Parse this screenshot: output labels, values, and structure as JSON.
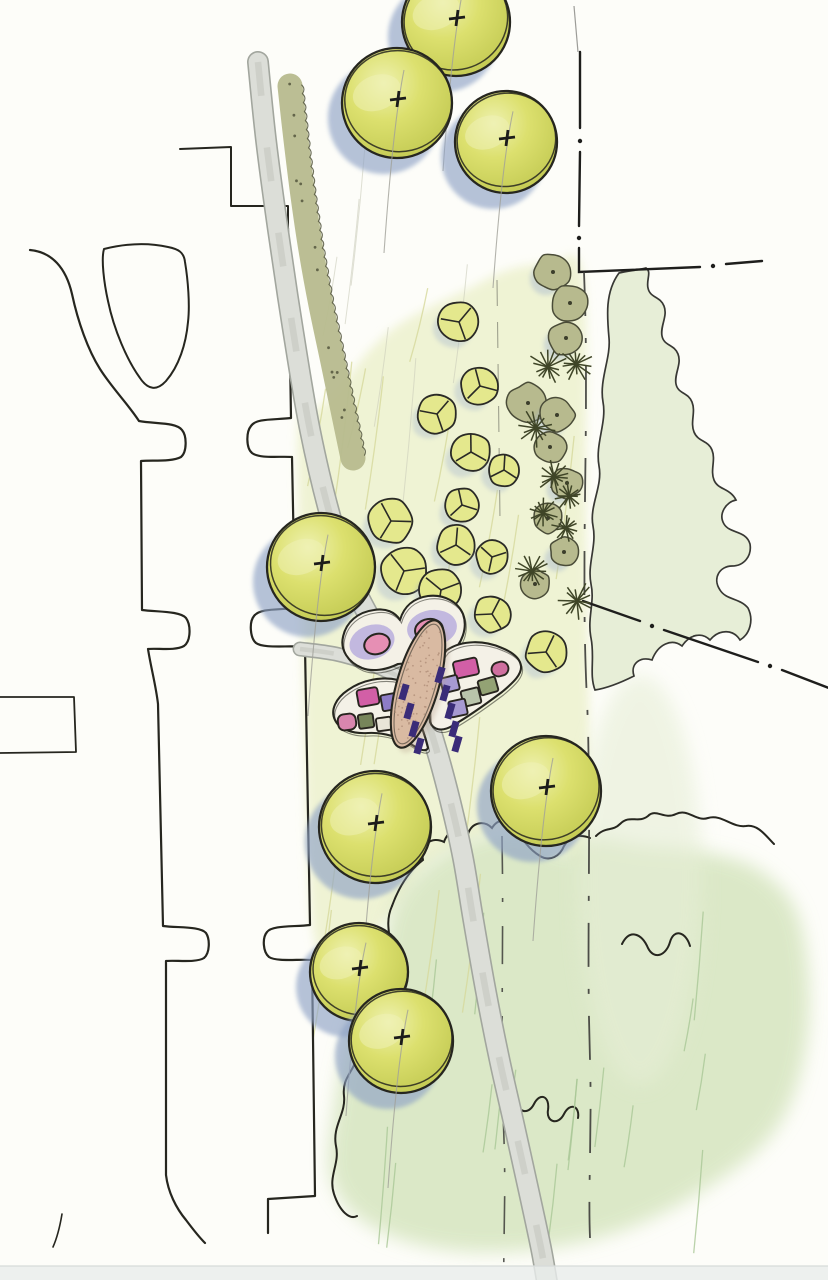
{
  "meta": {
    "width": 828,
    "height": 1280,
    "description": "Hand-drawn landscape architecture site plan sketch: street with curb cuts on the left, curving pedestrian path, watercolor shade trees, shrub and ornamental-grass border, lawn and meadow washes, property dash-dot lines, and a butterfly-shaped planting garden with benches at the center"
  },
  "palette": {
    "paper": "#fdfdf9",
    "ink": "#26261f",
    "pencil_gray": "#a6a69e",
    "tree_fill": "#dce06e",
    "tree_light": "#eef1b0",
    "tree_dark": "#c2c952",
    "tree_shadow": "#8fa3c6",
    "small_tree_fill": "#e4e88d",
    "shrub_olive": "#b7ba8e",
    "shrub_ink": "#4a4c38",
    "star_ink": "#3f4527",
    "lawn": "#eef2d0",
    "meadow": "#d6e5bf",
    "grove": "#e6eed6",
    "hatch_lawn": "#d6d89b",
    "hatch_meadow": "#a9c796",
    "path_fill": "#dcded8",
    "path_edge": "#a2a69e",
    "body_tan": "#d9baa2",
    "body_stipple": "#b08f79",
    "bench_purple": "#3a2c78",
    "wing_cream": "#f4f1e7",
    "wing_lavender": "#b9aedd",
    "wing_pink": "#e68fb4",
    "bottom_band": "#e9eceb"
  },
  "scene": {
    "inks": [
      {
        "name": "building-step-north",
        "d": "M 180,149 L 231,147 L 231,206 L 288,206 L 288,228",
        "w": 2
      },
      {
        "name": "curb-right",
        "d": "M 288,228 L 291,418 C 275,420 256,418 251,426 C 246,432 246,448 252,453 C 260,459 280,456 292,457 L 295,608 C 279,610 260,608 254,616 C 249,622 250,638 256,643 C 264,649 290,645 305,647 L 310,925 C 294,927 272,925 267,932 C 262,938 263,952 269,957 C 277,962 298,959 312,960 L 315,1196 L 268,1199 L 268,1233",
        "w": 2.2
      },
      {
        "name": "curb-left",
        "d": "M 30,250 C 52,252 66,268 72,294 C 78,322 88,350 100,369 C 112,388 128,404 139,421 C 155,424 176,422 182,430 C 187,436 187,452 181,457 C 172,462 152,460 141,461 L 142,610 C 158,612 180,611 186,618 C 191,625 191,641 184,646 C 175,651 158,648 148,649 C 151,668 156,686 158,704 L 163,926 C 178,928 200,926 206,933 C 210,939 210,953 204,958 C 196,963 176,960 166,961 L 166,1175 C 168,1192 176,1208 186,1220 C 192,1228 198,1236 205,1243",
        "w": 2.2
      },
      {
        "name": "existing-canopy-loop",
        "d": "M 104,249 C 128,243 150,243 168,247 C 178,249 184,252 185,262 C 188,280 190,305 188,322 C 186,344 179,366 166,381 C 157,391 148,390 140,378 C 127,360 114,330 108,301 C 104,283 101,259 104,249 Z",
        "w": 2
      },
      {
        "name": "stub-west",
        "d": "M 0,697 L 74,697 L 76,752 L 0,753",
        "w": 1.8
      },
      {
        "name": "stub-southwest",
        "d": "M 62,1214 C 60,1226 57,1238 53,1247",
        "w": 1.6
      }
    ],
    "boundary": {
      "segs": [
        "M 580,52 L 580,128",
        "M 580,152 L 579,226",
        "M 579,248 L 579,272 L 700,267",
        "M 726,264 L 762,261",
        "M 583,601 L 640,621",
        "M 664,630 L 758,662",
        "M 782,670 L 834,690"
      ],
      "dots": [
        [
          580,
          141
        ],
        [
          579,
          238
        ],
        [
          713,
          266
        ],
        [
          652,
          626
        ],
        [
          770,
          666
        ]
      ]
    },
    "dashed_lines": [
      {
        "name": "swale-line-east",
        "d": "M 584,272 C 590,420 580,560 587,700 C 592,820 586,940 590,1060 C 592,1130 588,1190 590,1238",
        "w": 1.8,
        "da": "44 22 5 22",
        "op": 0.9
      },
      {
        "name": "swale-line-west",
        "d": "M 502,836 C 504,940 500,1040 504,1140 C 506,1200 503,1248 504,1280",
        "w": 1.6,
        "da": "38 24 4 24",
        "op": 0.85
      },
      {
        "name": "pencil-guide-1",
        "d": "M 497,280 L 500,520",
        "w": 1.1,
        "da": "26 16",
        "op": 0.45
      },
      {
        "name": "pencil-guide-2",
        "d": "M 574,6 L 578,52",
        "w": 1.2,
        "da": "60 1",
        "op": 0.5
      }
    ],
    "lawn_poly": [
      [
        298,
        432
      ],
      [
        302,
        620
      ],
      [
        314,
        936
      ],
      [
        356,
        948
      ],
      [
        398,
        904
      ],
      [
        432,
        862
      ],
      [
        482,
        836
      ],
      [
        530,
        828
      ],
      [
        562,
        850
      ],
      [
        588,
        838
      ],
      [
        586,
        500
      ],
      [
        583,
        276
      ],
      [
        550,
        264
      ],
      [
        508,
        270
      ],
      [
        466,
        290
      ],
      [
        428,
        308
      ],
      [
        394,
        328
      ],
      [
        366,
        354
      ],
      [
        338,
        390
      ],
      [
        312,
        414
      ]
    ],
    "meadow_poly": [
      [
        392,
        908
      ],
      [
        422,
        868
      ],
      [
        472,
        838
      ],
      [
        526,
        830
      ],
      [
        566,
        852
      ],
      [
        592,
        838
      ],
      [
        644,
        846
      ],
      [
        704,
        852
      ],
      [
        762,
        872
      ],
      [
        800,
        922
      ],
      [
        808,
        1030
      ],
      [
        778,
        1126
      ],
      [
        700,
        1192
      ],
      [
        598,
        1238
      ],
      [
        478,
        1252
      ],
      [
        382,
        1232
      ],
      [
        332,
        1182
      ],
      [
        336,
        1098
      ],
      [
        352,
        1028
      ],
      [
        376,
        984
      ]
    ],
    "grove_path": "M 619,273 C 605,292 607,316 609,338 C 611,358 599,380 603,402 C 607,422 595,444 599,466 C 603,486 589,506 593,526 C 597,546 587,564 591,584 C 595,602 587,618 591,638 C 595,658 589,674 595,690 C 608,688 622,682 634,676 C 630,664 640,656 652,660 C 658,644 672,638 682,646 C 690,634 702,632 710,640 C 720,628 734,630 740,640 C 750,634 754,620 748,608 C 740,598 726,600 720,590 C 712,578 720,566 732,566 C 744,566 752,556 750,544 C 746,530 730,534 724,524 C 718,514 726,502 736,500 C 730,488 718,490 714,480 C 710,470 716,460 712,450 C 708,440 698,442 694,432 C 690,422 696,412 692,402 C 688,392 678,394 676,384 C 674,374 682,364 678,354 C 674,344 664,346 662,336 C 660,326 668,316 664,306 C 660,296 650,298 648,288 C 646,280 652,272 646,268 C 638,270 628,271 619,273 Z",
    "meadow_inks": [
      "M 392,906 C 400,884 410,870 423,860 C 420,844 432,836 444,842 C 448,830 460,826 468,834 C 472,822 484,820 492,828 C 498,818 510,818 516,826 C 520,838 530,850 540,856 C 550,862 560,856 564,846 C 570,836 580,834 590,838",
      "M 596,836 C 606,826 612,832 620,824 C 630,814 638,824 648,816 C 656,808 664,820 676,814 C 688,808 696,822 708,818 C 722,814 732,828 746,826 C 758,824 766,836 774,844",
      "M 392,906 C 382,928 396,946 390,966 C 384,986 372,998 378,1014 C 384,1028 364,1038 358,1056 C 352,1074 342,1078 344,1096 C 346,1114 332,1126 336,1146 C 340,1164 328,1176 334,1194 C 340,1212 350,1220 357,1216",
      "M 500,1096 C 508,1078 518,1084 517,1098 C 516,1112 528,1116 534,1104 C 540,1092 550,1096 548,1110 C 546,1122 558,1126 564,1114 C 570,1102 580,1106 578,1118",
      "M 622,944 C 630,928 642,934 648,948 C 654,960 666,956 670,942 C 674,928 686,932 690,946"
    ],
    "main_path": {
      "pts": [
        [
          258,
          62
        ],
        [
          266,
          140
        ],
        [
          278,
          230
        ],
        [
          293,
          330
        ],
        [
          310,
          430
        ],
        [
          330,
          515
        ],
        [
          352,
          582
        ],
        [
          378,
          632
        ],
        [
          402,
          670
        ],
        [
          422,
          706
        ],
        [
          436,
          748
        ],
        [
          450,
          800
        ],
        [
          463,
          858
        ],
        [
          473,
          918
        ],
        [
          486,
          992
        ],
        [
          500,
          1062
        ],
        [
          514,
          1124
        ],
        [
          529,
          1192
        ],
        [
          541,
          1248
        ],
        [
          547,
          1282
        ]
      ],
      "w": 22
    },
    "connector_path": {
      "pts": [
        [
          300,
          649
        ],
        [
          336,
          654
        ],
        [
          370,
          664
        ],
        [
          398,
          676
        ]
      ],
      "w": 15
    },
    "hedge": {
      "pts": [
        [
          290,
          86
        ],
        [
          296,
          140
        ],
        [
          303,
          196
        ],
        [
          311,
          250
        ],
        [
          321,
          305
        ],
        [
          333,
          362
        ],
        [
          344,
          415
        ],
        [
          353,
          458
        ]
      ],
      "w": 25
    },
    "hatch": [
      {
        "name": "lawn-hatch",
        "box": [
          315,
          275,
          265,
          650
        ],
        "count": 18,
        "len": 110,
        "dx": -18,
        "color": "#d6d89b",
        "w": 1.3,
        "op": 0.8,
        "seed": 7
      },
      {
        "name": "meadow-hatch",
        "box": [
          365,
          860,
          400,
          360
        ],
        "count": 16,
        "len": 85,
        "dx": -9,
        "color": "#a9c796",
        "w": 1.3,
        "op": 0.8,
        "seed": 11
      },
      {
        "name": "white-hatch",
        "box": [
          330,
          120,
          180,
          300
        ],
        "count": 6,
        "len": 120,
        "dx": -14,
        "color": "#c9cbb9",
        "w": 1,
        "op": 0.6,
        "seed": 3
      }
    ],
    "large_trees": [
      {
        "x": 456,
        "y": 22,
        "r": 54
      },
      {
        "x": 397,
        "y": 103,
        "r": 55
      },
      {
        "x": 506,
        "y": 142,
        "r": 51
      },
      {
        "x": 321,
        "y": 567,
        "r": 54
      },
      {
        "x": 375,
        "y": 827,
        "r": 56
      },
      {
        "x": 546,
        "y": 791,
        "r": 55
      },
      {
        "x": 359,
        "y": 972,
        "r": 49
      },
      {
        "x": 401,
        "y": 1041,
        "r": 52
      }
    ],
    "small_trees": [
      [
        459,
        322,
        20
      ],
      [
        480,
        386,
        19
      ],
      [
        437,
        414,
        19
      ],
      [
        471,
        452,
        19
      ],
      [
        504,
        470,
        16
      ],
      [
        462,
        505,
        17
      ],
      [
        391,
        521,
        22
      ],
      [
        456,
        545,
        19
      ],
      [
        492,
        557,
        16
      ],
      [
        404,
        571,
        23
      ],
      [
        441,
        590,
        21
      ],
      [
        492,
        614,
        18
      ],
      [
        546,
        652,
        20
      ]
    ],
    "shrubs": [
      [
        553,
        272,
        18
      ],
      [
        570,
        303,
        18
      ],
      [
        566,
        338,
        17
      ],
      [
        528,
        403,
        20
      ],
      [
        557,
        415,
        17
      ],
      [
        550,
        447,
        16
      ],
      [
        567,
        483,
        15
      ],
      [
        548,
        518,
        15
      ],
      [
        564,
        552,
        14
      ],
      [
        535,
        584,
        15
      ]
    ],
    "starbursts": [
      [
        548,
        367,
        20
      ],
      [
        576,
        364,
        18
      ],
      [
        536,
        428,
        20
      ],
      [
        554,
        477,
        17
      ],
      [
        569,
        496,
        15
      ],
      [
        543,
        513,
        16
      ],
      [
        566,
        528,
        15
      ],
      [
        532,
        571,
        18
      ],
      [
        577,
        601,
        20
      ]
    ],
    "butterfly": {
      "upper_wing": "M 398,664 C 386,670 372,672 362,668 C 348,662 340,650 343,637 C 346,622 358,612 374,610 C 386,608 395,612 400,620 C 404,606 414,598 428,596 C 444,594 458,602 463,614 C 468,628 462,644 450,654 C 440,662 428,666 420,662 Z",
      "right_wing": "M 447,650 C 462,640 484,640 502,648 C 512,652 520,658 521,666 C 522,674 514,682 502,692 C 486,704 466,718 452,726 C 442,732 433,730 430,722 C 428,700 432,668 447,650 Z",
      "left_wing": "M 398,680 C 382,676 362,680 348,690 C 336,698 330,710 335,720 C 339,729 352,734 368,733 C 384,732 402,738 414,746 C 420,750 426,752 428,748 C 422,722 408,694 398,680 Z",
      "lavender_lobes": [
        [
          372,
          642,
          23,
          17,
          -18
        ],
        [
          432,
          628,
          25,
          18,
          -8
        ]
      ],
      "pink_rounds": [
        [
          377,
          644,
          13,
          10,
          -18
        ],
        [
          429,
          630,
          14,
          11,
          -8
        ]
      ],
      "beds": [
        [
          466,
          668,
          24,
          17,
          -12,
          "#d25fa6",
          3
        ],
        [
          500,
          669,
          17,
          14,
          -16,
          "#cf6f9f",
          7
        ],
        [
          450,
          684,
          17,
          15,
          -14,
          "#a79ad2",
          2
        ],
        [
          488,
          686,
          18,
          15,
          -16,
          "#93a274",
          2
        ],
        [
          471,
          697,
          18,
          16,
          -14,
          "#b9c4ab",
          2
        ],
        [
          458,
          708,
          17,
          16,
          -12,
          "#a79ad2",
          2
        ],
        [
          368,
          697,
          21,
          17,
          -10,
          "#d25fa6",
          3
        ],
        [
          390,
          702,
          17,
          16,
          -10,
          "#8d7cc6",
          2
        ],
        [
          347,
          722,
          18,
          16,
          -8,
          "#d886ae",
          6
        ],
        [
          366,
          721,
          15,
          14,
          -8,
          "#77855a",
          2
        ],
        [
          384,
          724,
          15,
          13,
          -8,
          "#e9e5d8",
          2
        ],
        [
          401,
          728,
          15,
          14,
          -8,
          "#a79ad2",
          2
        ]
      ],
      "body": {
        "cx": 418,
        "cy": 684,
        "rx": 21,
        "ry": 66,
        "rot": 16
      },
      "benches": [
        [
          404,
          692
        ],
        [
          409,
          711
        ],
        [
          414,
          729
        ],
        [
          419,
          746
        ],
        [
          440,
          675
        ],
        [
          445,
          693
        ],
        [
          450,
          711
        ],
        [
          454,
          729
        ],
        [
          457,
          744
        ]
      ],
      "bench_size": [
        7,
        16
      ]
    }
  }
}
